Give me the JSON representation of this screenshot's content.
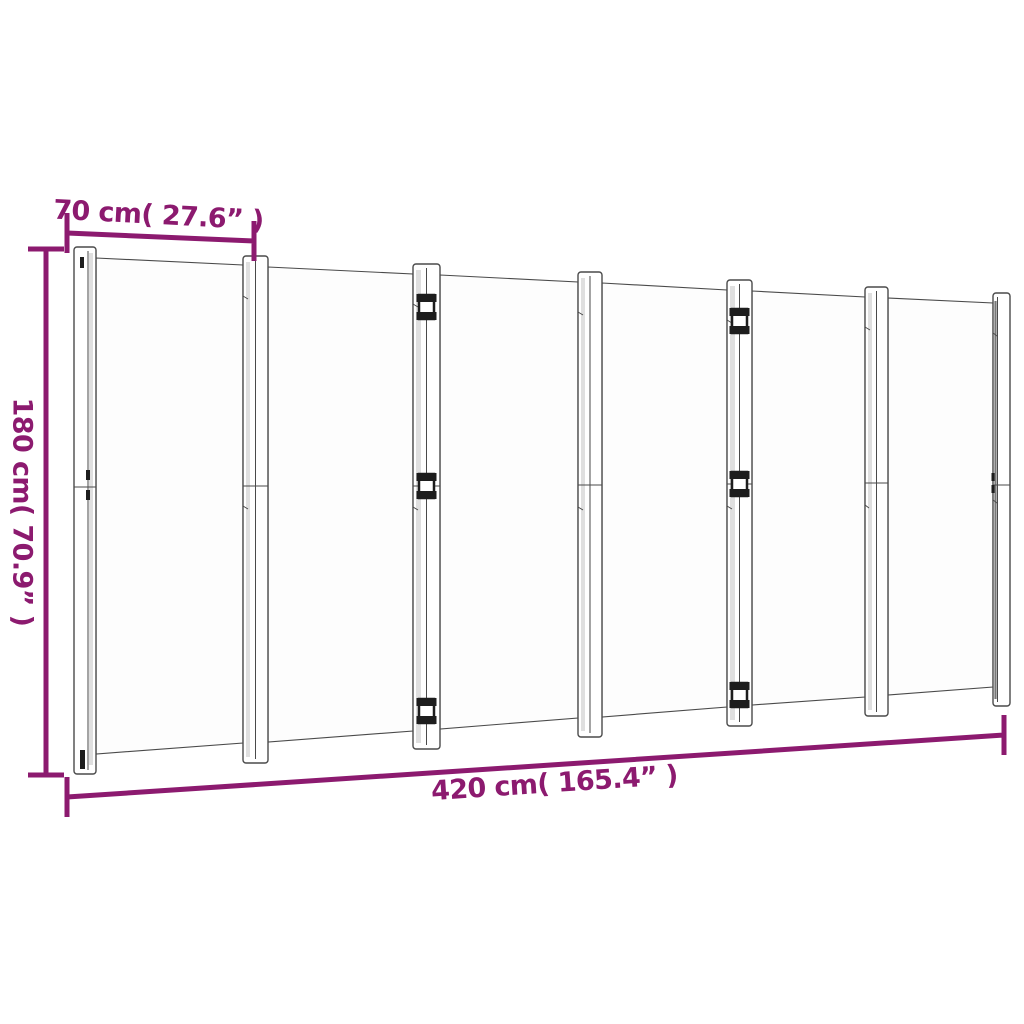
{
  "figure": {
    "kind": "room-divider-dimension-diagram",
    "panels_count": 6
  },
  "dimensions": {
    "panel_width": {
      "label": "70 cm( 27.6” )"
    },
    "height": {
      "label": "180 cm( 70.9” )"
    },
    "total_width": {
      "label": "420 cm( 165.4” )"
    }
  },
  "colors": {
    "background": "#ffffff",
    "dimension": "#8C1A6F",
    "outline": "#4a4a4a",
    "panel_fill": "#fdfdfd",
    "shade": "#d9d9d9",
    "dark": "#1d1d1d"
  }
}
